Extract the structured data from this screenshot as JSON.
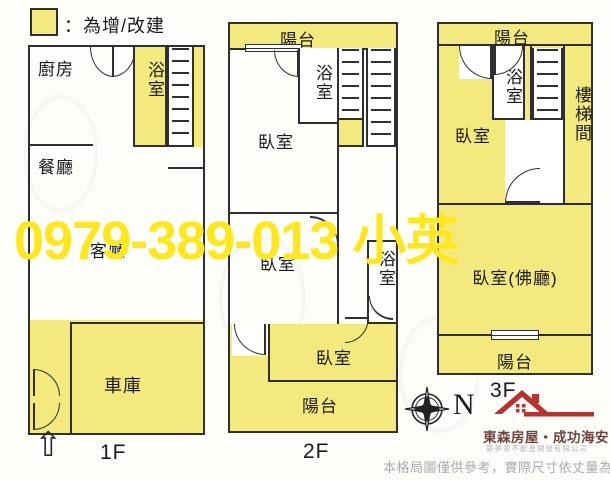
{
  "legend": {
    "label": "：為增/改建",
    "swatch_color": "#f4e97c"
  },
  "watermark": {
    "text": "0979-389-013 小英",
    "color": "#ffe71e"
  },
  "floors": {
    "f1": {
      "label": "1F",
      "kitchen": "廚房",
      "bath": "浴室",
      "dining": "餐廳",
      "living": "客廳",
      "garage": "車庫"
    },
    "f2": {
      "label": "2F",
      "balcony_top": "陽台",
      "bath_top": "浴室",
      "bedroom_top": "臥室",
      "bedroom_mid": "臥室",
      "bath_mid": "浴室",
      "bedroom_bottom": "臥室",
      "balcony_bottom": "陽台"
    },
    "f3": {
      "label": "3F",
      "balcony_top": "陽台",
      "bath": "浴室",
      "stairwell": "樓梯間",
      "bedroom_top": "臥室",
      "bedroom_hall": "臥室(佛廳)",
      "balcony_bottom": "陽台"
    }
  },
  "compass": {
    "north_label": "N"
  },
  "icons": {
    "entrance_arrow": "⇧"
  },
  "branding": {
    "name": "東森房屋‧成功海安",
    "subtitle": "築夢家不動產開發有限公司",
    "accent_color": "#b5342f"
  },
  "footer": {
    "disclaimer": "本格局圖僅供參考，實際尺寸依丈量為準"
  },
  "colors": {
    "highlight_yellow": "#f4e97c",
    "wall": "#2f2f2f",
    "watermark_yellow": "#ffe71e",
    "logo_red": "#b5342f"
  }
}
